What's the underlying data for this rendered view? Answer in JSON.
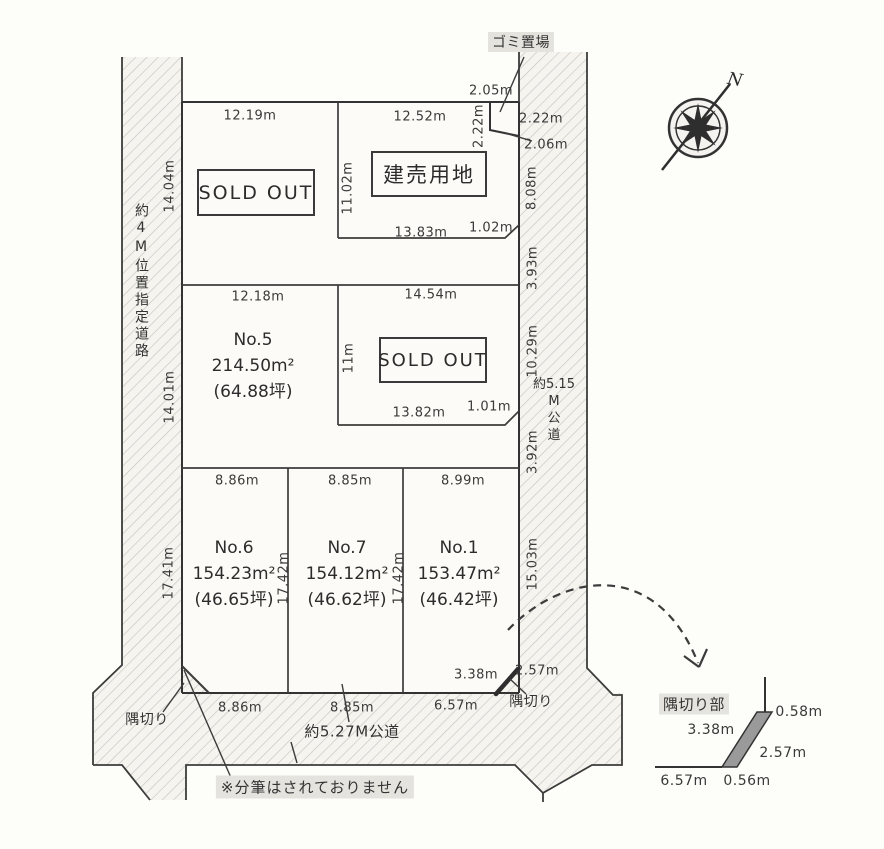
{
  "title": "分譲地区画図",
  "compass": {
    "north_label": "N"
  },
  "roads": {
    "left": {
      "label": "約4M位置指定道路"
    },
    "right": {
      "lines": [
        "約5.15",
        "M",
        "公",
        "道"
      ]
    },
    "bottom": {
      "label": "約5.27M公道"
    }
  },
  "garbage": {
    "label": "ゴミ置場"
  },
  "note": {
    "text": "※分筆はされておりません"
  },
  "corner_cut": {
    "left_label": "隅切り",
    "right_label": "隅切り"
  },
  "blocks": {
    "sold_out_1": "SOLD OUT",
    "tateuri": "建売用地",
    "sold_out_2": "SOLD OUT"
  },
  "lots": [
    {
      "name": "No.5",
      "area_m2": "214.50m²",
      "area_tsubo": "(64.88坪)"
    },
    {
      "name": "No.6",
      "area_m2": "154.23m²",
      "area_tsubo": "(46.65坪)"
    },
    {
      "name": "No.7",
      "area_m2": "154.12m²",
      "area_tsubo": "(46.62坪)"
    },
    {
      "name": "No.1",
      "area_m2": "153.47m²",
      "area_tsubo": "(46.42坪)"
    }
  ],
  "dims": {
    "top_left_width": "12.19m",
    "top_right_width": "12.52m",
    "garbage_top": "2.05m",
    "garbage_left": "2.22m",
    "garbage_right": "2.22m",
    "garbage_bottom": "2.06m",
    "tateuri_left": "11.02m",
    "tateuri_bottom": "13.83m",
    "tateuri_corner": "1.02m",
    "right_edge_upper": "8.08m",
    "right_edge_gap1": "3.93m",
    "left_edge_upper": "14.04m",
    "left_edge_mid": "14.01m",
    "no5_top": "12.18m",
    "mid_right_top": "14.54m",
    "mid_right_left": "11m",
    "mid_right_bottom": "13.82m",
    "mid_right_corner": "1.01m",
    "right_edge_mid": "10.29m",
    "right_edge_gap2": "3.92m",
    "no6_top": "8.86m",
    "no7_top": "8.85m",
    "no1_top": "8.99m",
    "no6_left": "17.41m",
    "no7_left": "17.42m",
    "no1_left": "17.42m",
    "right_edge_lower": "15.03m",
    "no1_cut_top": "3.38m",
    "no1_cut_right": "2.57m",
    "no6_bottom": "8.86m",
    "no7_bottom": "8.85m",
    "no1_bottom": "6.57m"
  },
  "detail": {
    "title": "隅切り部",
    "left": "3.38m",
    "top_right": "0.58m",
    "diagonal": "2.57m",
    "bottom_left": "6.57m",
    "bottom_right": "0.56m"
  },
  "colors": {
    "line": "#3c3c3c",
    "hatch": "#c6c5c1",
    "road_bg": "#f5f4ef",
    "plot_bg": "#fcfbf7",
    "highlight_bg": "#e4e3de",
    "corner_band": "#9a9a9a"
  }
}
